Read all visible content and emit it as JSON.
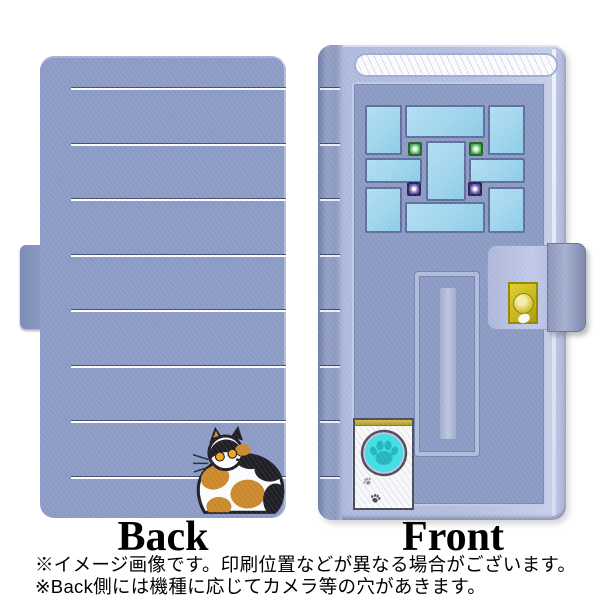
{
  "product_image": {
    "type": "smartphone flip-case product mockup",
    "back_panel": {
      "label": "Back",
      "design": "periwinkle leather texture with horizontal white pinstripes and calico cat illustration",
      "stripe_count": 8
    },
    "front_panel": {
      "label": "Front",
      "design": "house door with 9-pane window, two green and two purple lights, mail slot, gold doorknob on magnetic clasp, white doorbell plate with cyan paw-print button and small paw prints"
    },
    "notes": {
      "line1": "※イメージ画像です。印刷位置などが異なる場合がございます。",
      "line2": "※Back側には機種に応じてカメラ等の穴があきます。"
    },
    "palette": {
      "case_base": "#8d9dc7",
      "frame_light": "#b7c1e1",
      "stripe_white": "#ffffff",
      "stripe_shadow": "#434e74",
      "window_pane": "#a2daf2",
      "window_muntin": "#5d6d9d",
      "light_green": "#2f9e3c",
      "light_purple": "#43398f",
      "doorknob_gold": "#c4b214",
      "doorbell_cyan": "#3ce4ea",
      "paw_teal": "#1fb8bc",
      "cat_orange": "#cd8a2a",
      "cat_black": "#1e1e24",
      "text_black": "#000000"
    }
  }
}
